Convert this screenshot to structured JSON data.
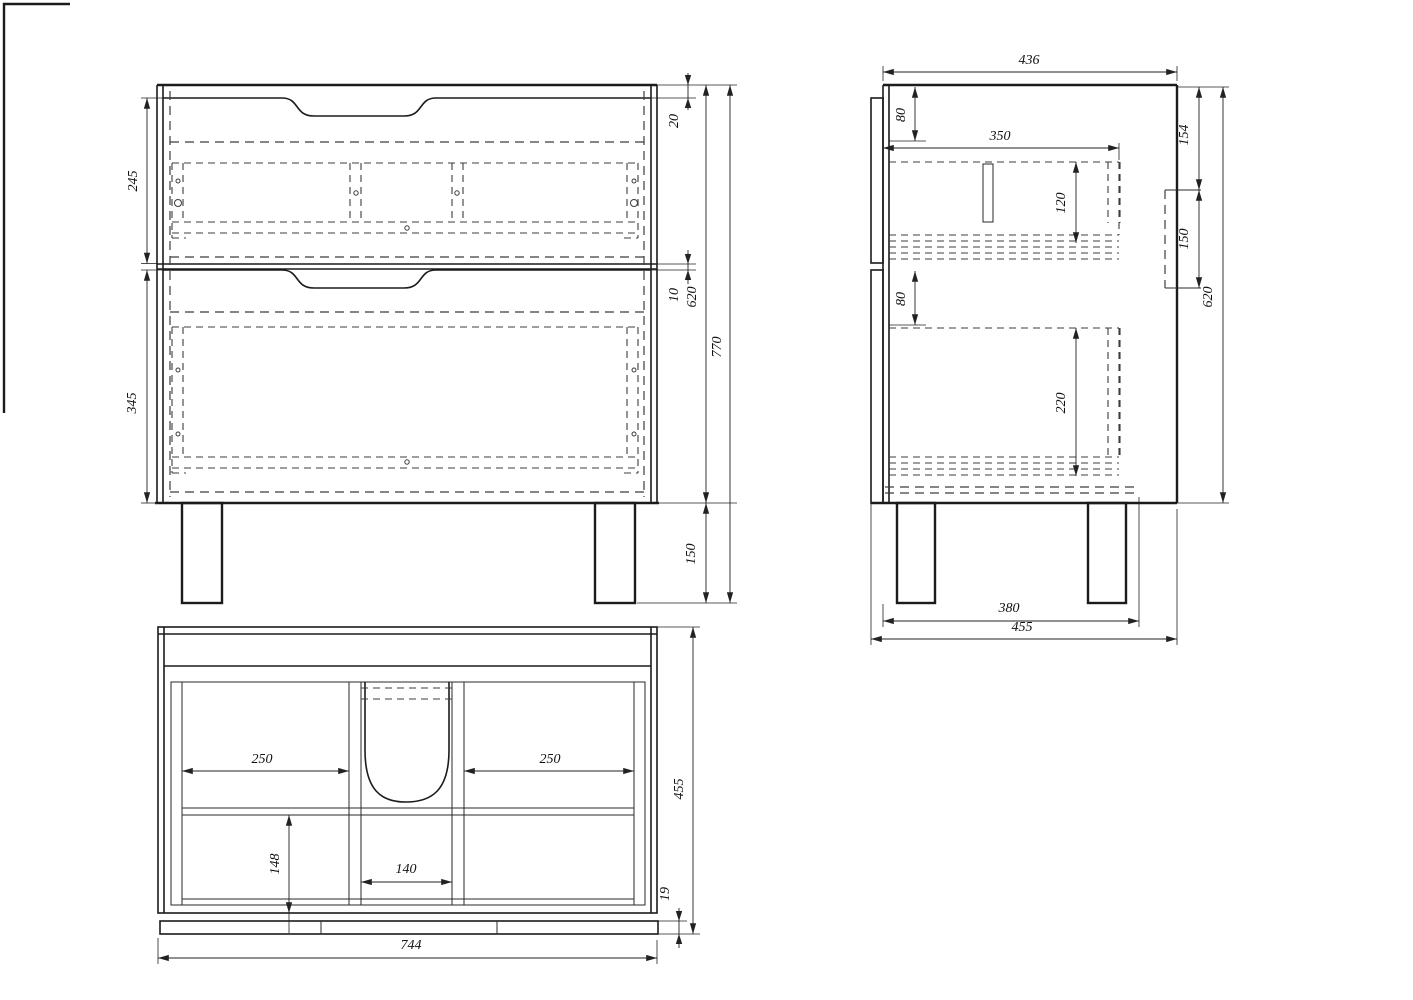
{
  "drawing": {
    "type": "furniture-assembly-drawing",
    "views": {
      "front": "front-view",
      "side": "side-view",
      "plan": "plan-view"
    }
  },
  "dims": {
    "front": {
      "drawer_top_height": "245",
      "drawer_bottom_height": "345",
      "top_offset": "20",
      "gap": "10",
      "carcass_height": "620",
      "total_height": "770",
      "leg_height": "150"
    },
    "side": {
      "carcass_depth": "436",
      "top_inset": "80",
      "drawer_depth": "350",
      "drawer_top_inner": "120",
      "bracket_offset": "154",
      "bracket_height": "150",
      "lower_inset": "80",
      "drawer_bottom_inner": "220",
      "carcass_height": "620",
      "leg_span": "380",
      "total_depth": "455"
    },
    "plan": {
      "bay_left": "250",
      "bay_right": "250",
      "rear_depth": "148",
      "sink_gap": "140",
      "total_depth": "455",
      "front_thickness": "19",
      "total_width": "744"
    }
  }
}
